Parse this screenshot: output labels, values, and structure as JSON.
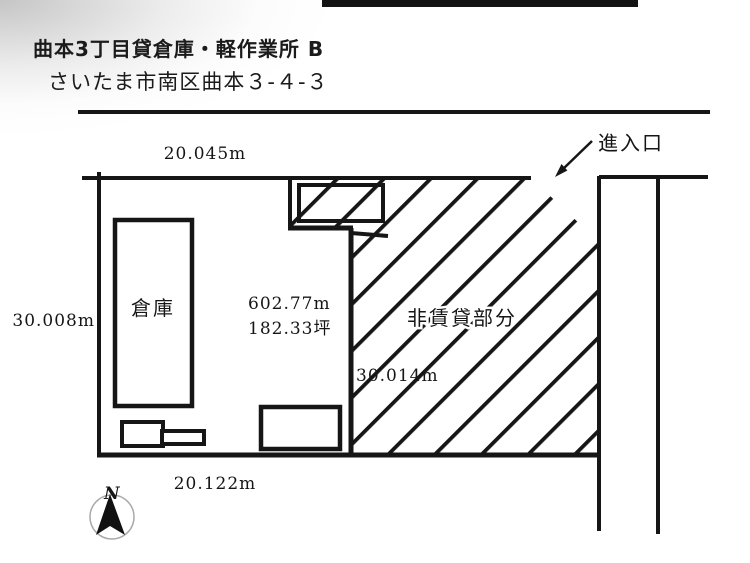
{
  "header": {
    "title": "曲本3丁目貸倉庫・軽作業所 B",
    "address": "さいたま市南区曲本３-４-３"
  },
  "plan": {
    "dimensions": {
      "top": "20.045m",
      "left": "30.008m",
      "bottom": "20.122m",
      "inner_right": "30.014m"
    },
    "area": {
      "square_meters": "602.77m",
      "tsubo": "182.33坪"
    },
    "labels": {
      "warehouse": "倉庫",
      "non_rental": "非賃貸部分",
      "entrance": "進入口",
      "north": "N"
    }
  },
  "colors": {
    "line": "#161616",
    "background": "#ffffff",
    "scan_shade": "#bdbdbd",
    "top_bar": "#141414"
  }
}
